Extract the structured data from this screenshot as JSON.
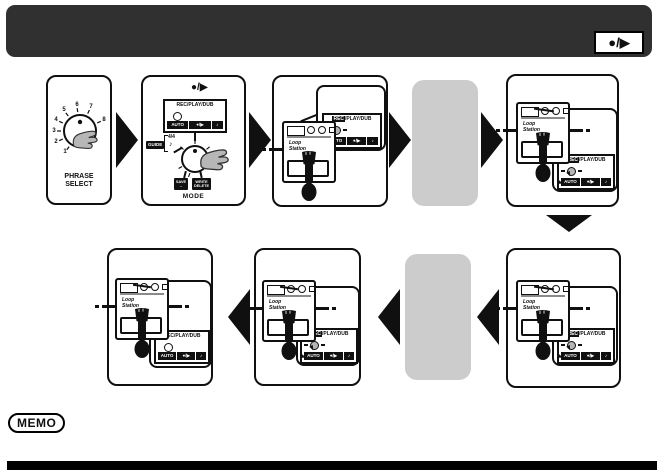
{
  "header": {
    "badge_label": "●/▶"
  },
  "memo": {
    "label": "MEMO"
  },
  "pedal": {
    "name_line1": "Loop",
    "name_line2": "Station"
  },
  "panels": {
    "phrase_select": {
      "numbers": [
        "1",
        "2",
        "3",
        "4",
        "5",
        "6",
        "7",
        "8"
      ],
      "label_line1": "PHRASE",
      "label_line2": "SELECT"
    },
    "mode": {
      "top_symbol": "●/▶",
      "display": {
        "hl": "",
        "rest": "REC/PLAY/DUB",
        "cells": [
          "AUTO",
          "●/▶",
          "♪"
        ]
      },
      "guide_label": "GUIDE",
      "time_signature": "4/4",
      "note_symbol": "♪",
      "badge_save_line1": "SAVE",
      "badge_save_line2": "→",
      "badge_write_line1": "WRITE",
      "badge_write_line2": "DELETE",
      "knob_label": "MODE"
    },
    "step3": {
      "display": {
        "hl": "REC",
        "rest": "/PLAY/DUB",
        "cells": [
          "AUTO",
          "●/▶",
          "♪"
        ]
      }
    },
    "step4": {
      "display": {
        "hl": "REC",
        "rest": "/PLAY/DUB",
        "cells": [
          "AUTO",
          "●/▶",
          "♪"
        ]
      }
    },
    "step5": {
      "display": {
        "hl": "REC",
        "rest": "/PLAY/DUB",
        "cells": [
          "AUTO",
          "●/▶",
          "♪"
        ]
      }
    },
    "step6": {
      "display": {
        "hl": "REC",
        "rest": "/PLAY/DUB",
        "cells": [
          "AUTO",
          "●/▶",
          "♪"
        ]
      }
    },
    "step7": {
      "display": {
        "hl": "",
        "rest": "REC/PLAY/DUB",
        "cells": [
          "AUTO",
          "●/▶",
          "♪"
        ]
      }
    }
  },
  "colors": {
    "header_bg": "#303030",
    "placeholder_gray": "#cccccc",
    "line_black": "#101010",
    "hand_gray": "#b7b7b7"
  }
}
